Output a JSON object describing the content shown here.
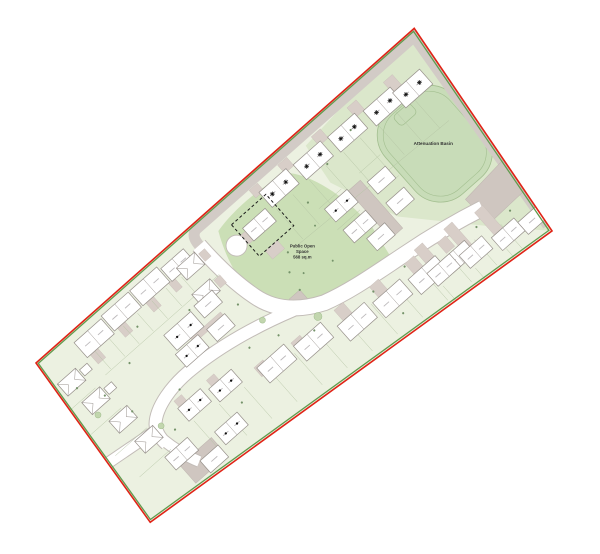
{
  "labels": {
    "attenuation_basin": "Attenuation Basin",
    "public_open_space_line1": "Public Open",
    "public_open_space_line2": "Space",
    "public_open_space_line3": "568 sq.m"
  },
  "colors": {
    "page_background": "#ffffff",
    "site_boundary_red": "#e02417",
    "site_boundary_inner_green": "#609a4d",
    "site_base_green": "#ecf1e1",
    "landscape_green": "#dbe7cb",
    "open_space_green": "#cbdfb6",
    "basin_green": "#c8dcb8",
    "garden_plot_line": "#b5c4a4",
    "road_white": "#ffffff",
    "road_casing": "#c2bcb7",
    "secondary_road_gray": "#d2cbc6",
    "parking_court_gray": "#cfc6c0",
    "driveway_gray": "#d8cec8",
    "house_fill": "#ffffff",
    "house_outline": "#96908a",
    "unit_marker_black": "#101010"
  },
  "icons": {
    "affordable_unit_marker": "star-asterisk",
    "unit_marker": "filled-dot",
    "reserved_plot_outline": "black-dashed-rectangle"
  }
}
